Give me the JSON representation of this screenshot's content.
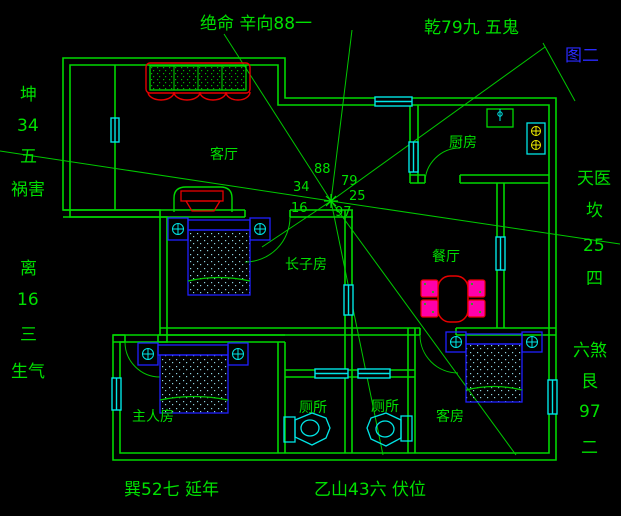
{
  "figure": {
    "label": "图二"
  },
  "labels": {
    "fate_top_left": "绝命 辛向88一",
    "fate_top_right": "乾79九 五鬼",
    "west_group": [
      "坤",
      "34",
      "五",
      "祸害"
    ],
    "southwest_group": [
      "离",
      "16",
      "三",
      "生气"
    ],
    "east_group": [
      "天医",
      "坎",
      "25",
      "四"
    ],
    "southeast_group": [
      "六煞",
      "艮",
      "97",
      "二"
    ],
    "fate_bottom_left": "巽52七 延年",
    "fate_bottom_center": "乙山43六 伏位"
  },
  "rooms": {
    "living_room": "客厅",
    "kitchen": "厨房",
    "dining_room": "餐厅",
    "eldest_son_room": "长子房",
    "master_bedroom": "主人房",
    "toilet_left": "厕所",
    "toilet_right": "厕所",
    "guest_room": "客房"
  },
  "compass_numbers": {
    "top": "88",
    "top_right": "79",
    "top_left": "34",
    "right": "25",
    "left": "16",
    "bottom": "97"
  },
  "colors": {
    "background": "#000000",
    "wall_green": "#00d800",
    "text_green": "#00e000",
    "window_cyan": "#00e5e5",
    "furniture_blue": "#2020ff",
    "accent_red": "#e80000",
    "chair_magenta": "#ff00aa",
    "burner_yellow": "#f0f000",
    "figure_blue": "#2a2aff"
  }
}
